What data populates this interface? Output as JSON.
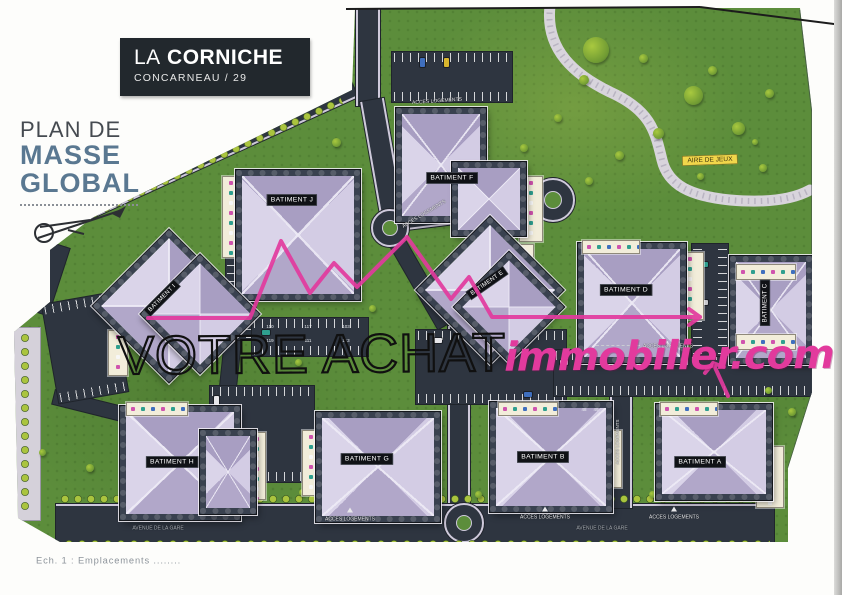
{
  "title_block": {
    "prefix": "LA",
    "name": "CORNICHE",
    "subtitle": "CONCARNEAU / 29"
  },
  "plan_label": {
    "line1": "PLAN DE",
    "line2": "MASSE",
    "line3": "GLOBAL"
  },
  "watermark": {
    "outline": "VOTRE ACHAT",
    "brand": "immobilier.com"
  },
  "map": {
    "buildings": [
      {
        "label": "BATIMENT A"
      },
      {
        "label": "BATIMENT B"
      },
      {
        "label": "BATIMENT C"
      },
      {
        "label": "BATIMENT D"
      },
      {
        "label": "BATIMENT E"
      },
      {
        "label": "BATIMENT F"
      },
      {
        "label": "BATIMENT G"
      },
      {
        "label": "BATIMENT H"
      },
      {
        "label": "BATIMENT I"
      },
      {
        "label": "BATIMENT J"
      }
    ],
    "playground_label": "AIRE DE JEUX",
    "road_labels": [
      {
        "text": "ACCES VEHICULES"
      },
      {
        "text": "ACCES LOGEMENTS"
      },
      {
        "text": "ACCES LOGEMENTS"
      },
      {
        "text": "ACCES LOGEMENTS"
      },
      {
        "text": "ACCES LOGEMENTS"
      },
      {
        "text": "ACCES LOGEMENTS"
      },
      {
        "text": "ACCES LOGEMENTS"
      },
      {
        "text": "AVENUE DE LA GARE"
      },
      {
        "text": "AVENUE DE LA GARE"
      },
      {
        "text": "ACCES LOGEMENTS"
      }
    ],
    "parking_numbers": [
      "110",
      "119",
      "117",
      "111",
      "103",
      "113",
      "48",
      "49"
    ]
  },
  "caption": "Ech. 1 : Emplacements ........",
  "colors": {
    "grass": "#5c8d3b",
    "road": "#2e3540",
    "roof": "#c9c1dc",
    "pink": "#e23a9d",
    "badge": "#f1d64b",
    "plan_blue": "#5a7891",
    "title_bg": "#22282d"
  }
}
